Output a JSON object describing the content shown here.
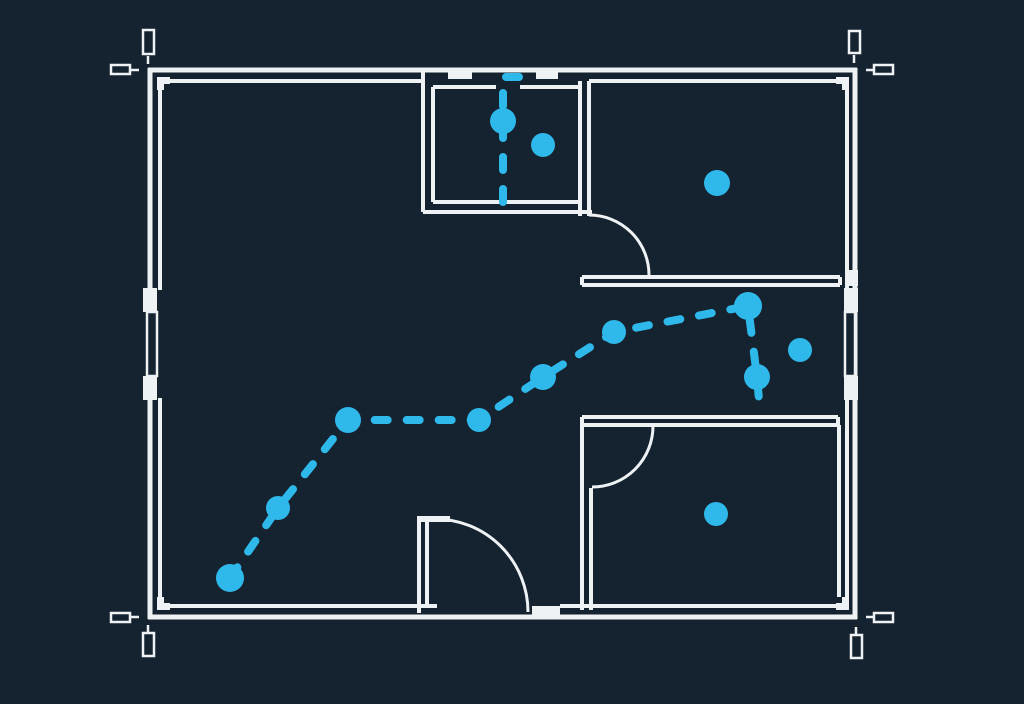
{
  "meta": {
    "title": "Blueprint floor plan with dashed route",
    "width": 1024,
    "height": 704
  },
  "colors": {
    "background": "#15222f",
    "wall": "#eef2f5",
    "route": "#2fb9eb"
  },
  "plan": {
    "wall_lines": [
      [
        148,
        70,
        857,
        70,
        5
      ],
      [
        148,
        617,
        857,
        617,
        5
      ],
      [
        150,
        68,
        150,
        619,
        5
      ],
      [
        855,
        68,
        855,
        619,
        5
      ],
      [
        160,
        81,
        423,
        81,
        4
      ],
      [
        589,
        81,
        847,
        81,
        4
      ],
      [
        160,
        81,
        160,
        290,
        4
      ],
      [
        160,
        398,
        160,
        607,
        4
      ],
      [
        847,
        81,
        847,
        290,
        4
      ],
      [
        847,
        398,
        847,
        607,
        4
      ],
      [
        160,
        606,
        437,
        606,
        4
      ],
      [
        560,
        606,
        847,
        606,
        4
      ],
      [
        423,
        70,
        423,
        212,
        4
      ],
      [
        433,
        87,
        433,
        202,
        4
      ],
      [
        433,
        87,
        496,
        87,
        4
      ],
      [
        520,
        87,
        580,
        87,
        4
      ],
      [
        433,
        202,
        580,
        202,
        4
      ],
      [
        423,
        212,
        592,
        212,
        4
      ],
      [
        580,
        81,
        580,
        216,
        4
      ],
      [
        589,
        81,
        589,
        216,
        4
      ],
      [
        582,
        277,
        840,
        277,
        4
      ],
      [
        582,
        285,
        840,
        285,
        4
      ],
      [
        582,
        277,
        582,
        285,
        4
      ],
      [
        840,
        277,
        840,
        285,
        4
      ],
      [
        582,
        417,
        838,
        417,
        4
      ],
      [
        582,
        425,
        838,
        425,
        4
      ],
      [
        838,
        417,
        838,
        425,
        4
      ],
      [
        582,
        417,
        582,
        610,
        4
      ],
      [
        591,
        488,
        591,
        610,
        4
      ],
      [
        839,
        425,
        839,
        606,
        4
      ],
      [
        419,
        517,
        419,
        613,
        4
      ],
      [
        427,
        517,
        427,
        604,
        4
      ],
      [
        417,
        519,
        450,
        519,
        6
      ]
    ],
    "wall_blocks": [
      [
        448,
        71,
        24,
        8
      ],
      [
        536,
        71,
        22,
        8
      ],
      [
        532,
        606,
        28,
        13
      ],
      [
        143,
        288,
        14,
        24
      ],
      [
        143,
        376,
        14,
        24
      ],
      [
        844,
        288,
        14,
        24
      ],
      [
        844,
        376,
        14,
        24
      ],
      [
        848,
        270,
        10,
        16
      ],
      [
        157,
        77,
        13,
        13
      ],
      [
        836,
        77,
        13,
        13
      ],
      [
        157,
        597,
        13,
        13
      ],
      [
        836,
        597,
        13,
        13
      ]
    ],
    "joint_notches": [
      [
        164,
        84,
        6,
        6
      ],
      [
        836,
        84,
        6,
        6
      ],
      [
        164,
        597,
        6,
        6
      ],
      [
        836,
        597,
        6,
        6
      ]
    ],
    "window_panes": [
      [
        147,
        312,
        10,
        64
      ],
      [
        845,
        312,
        10,
        64
      ]
    ],
    "door_arcs": [
      "M 589 215 A 60 60 0 0 1 649 275",
      "M 653 426 A 61 61 0 0 1 592 487",
      "M 435 519 A 93 93 0 0 1 528 612"
    ],
    "door_arc_width": 3
  },
  "registration": {
    "stroke": 2.5,
    "rects": [
      [
        143,
        30,
        11,
        24
      ],
      [
        111,
        65,
        19,
        9
      ],
      [
        849,
        31,
        11,
        22
      ],
      [
        874,
        65,
        19,
        9
      ],
      [
        111,
        613,
        19,
        9
      ],
      [
        143,
        633,
        11,
        23
      ],
      [
        874,
        613,
        19,
        9
      ],
      [
        851,
        635,
        11,
        23
      ]
    ],
    "ticks": [
      [
        148,
        56,
        148,
        64
      ],
      [
        131,
        70,
        139,
        70
      ],
      [
        854,
        55,
        854,
        63
      ],
      [
        866,
        70,
        874,
        70
      ],
      [
        131,
        617,
        139,
        617
      ],
      [
        148,
        625,
        148,
        633
      ],
      [
        866,
        617,
        874,
        617
      ],
      [
        856,
        627,
        856,
        635
      ]
    ]
  },
  "route": {
    "stroke": 8,
    "dash": "13 19",
    "segments": {
      "entry": [
        [
          519,
          77
        ],
        [
          503,
          77
        ],
        [
          503,
          202
        ]
      ],
      "main": [
        [
          230,
          578
        ],
        [
          278,
          508
        ],
        [
          348,
          420
        ],
        [
          479,
          420
        ],
        [
          543,
          377
        ],
        [
          614,
          332
        ],
        [
          748,
          306
        ],
        [
          757,
          377
        ],
        [
          760,
          411
        ]
      ]
    },
    "nodes": [
      [
        503,
        121,
        13
      ],
      [
        230,
        578,
        14
      ],
      [
        278,
        508,
        12
      ],
      [
        348,
        420,
        13
      ],
      [
        479,
        420,
        12
      ],
      [
        543,
        377,
        13
      ],
      [
        614,
        332,
        12
      ],
      [
        748,
        306,
        14
      ],
      [
        757,
        377,
        13
      ]
    ]
  },
  "markers": {
    "dots": [
      [
        543,
        145,
        12
      ],
      [
        717,
        183,
        13
      ],
      [
        800,
        350,
        12
      ],
      [
        716,
        514,
        12
      ]
    ]
  }
}
